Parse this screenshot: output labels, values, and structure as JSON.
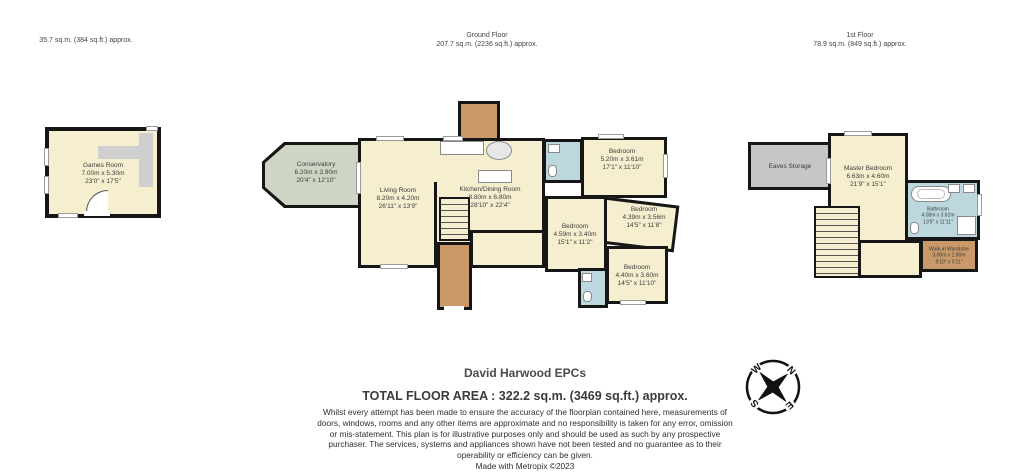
{
  "floors": {
    "outbuilding": {
      "area_label": "35.7 sq.m. (384 sq.ft.) approx."
    },
    "ground": {
      "title": "Ground Floor",
      "area_label": "207.7 sq.m. (2236 sq.ft.) approx."
    },
    "first": {
      "title": "1st Floor",
      "area_label": "78.9 sq.m. (849 sq.ft.) approx."
    }
  },
  "rooms": {
    "games_room": {
      "name": "Games Room",
      "metric": "7.00m x 5.30m",
      "imperial": "23'0\" x 17'5\""
    },
    "conservatory": {
      "name": "Conservatory",
      "metric": "6.20m x 3.90m",
      "imperial": "20'4\" x 12'10\""
    },
    "living_room": {
      "name": "Living Room",
      "metric": "8.20m x 4.20m",
      "imperial": "26'11\" x 13'9\""
    },
    "kitchen_dining": {
      "name": "Kitchen/Dining Room",
      "metric": "8.80m x 6.80m",
      "imperial": "28'10\" x 22'4\""
    },
    "bedroom_top": {
      "name": "Bedroom",
      "metric": "5.20m x 3.61m",
      "imperial": "17'1\" x 11'10\""
    },
    "bedroom_right": {
      "name": "Bedroom",
      "metric": "4.39m x 3.56m",
      "imperial": "14'5\" x 11'8\""
    },
    "bedroom_center": {
      "name": "Bedroom",
      "metric": "4.59m x 3.40m",
      "imperial": "15'1\" x 11'2\""
    },
    "bedroom_bottom": {
      "name": "Bedroom",
      "metric": "4.40m x 3.60m",
      "imperial": "14'5\" x 11'10\""
    },
    "eaves_storage": {
      "name": "Eaves Storage"
    },
    "master_bedroom": {
      "name": "Master Bedroom",
      "metric": "6.63m x 4.60m",
      "imperial": "21'9\" x 15'1\""
    },
    "bathroom": {
      "name": "Bathroom",
      "metric": "4.08m x 3.62m",
      "imperial": "13'5\" x 11'11\""
    },
    "walk_in_wardrobe": {
      "name": "Walk-in Wardrobe",
      "metric": "3.00m x 1.80m",
      "imperial": "9'10\" x 5'11\""
    }
  },
  "footer": {
    "company": "David Harwood EPCs",
    "total_area": "TOTAL FLOOR AREA : 322.2 sq.m. (3469 sq.ft.) approx.",
    "disclaimer": "Whilst every attempt has been made to ensure the accuracy of the floorplan contained here, measurements of doors, windows, rooms and any other items are approximate and no responsibility is taken for any error, omission or mis-statement. This plan is for illustrative purposes only and should be used as such by any prospective purchaser. The services, systems and appliances shown have not been tested and no guarantee as to their operability or efficiency can be given.",
    "credit": "Made with Metropix ©2023"
  },
  "compass": {
    "n": "N",
    "e": "E",
    "s": "S",
    "w": "W"
  },
  "colors": {
    "wall": "#161616",
    "room_cream": "#f6efcf",
    "conservatory_green": "#ced5c4",
    "bathroom_blue": "#bcd7dd",
    "hall_brown": "#c9996a",
    "storage_gray": "#c6c6c6"
  }
}
